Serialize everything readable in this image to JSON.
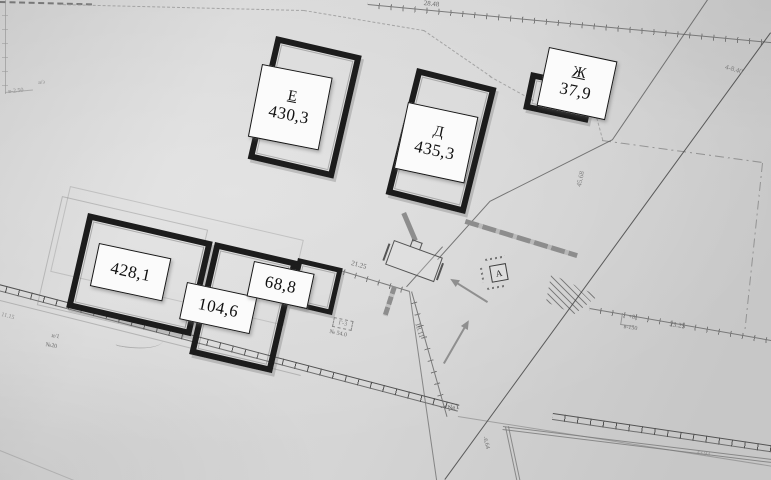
{
  "buildings": [
    {
      "letter": "Е",
      "area": "430,3"
    },
    {
      "letter": "Д",
      "area": "435,3"
    },
    {
      "letter": "Ж",
      "area": "37,9"
    },
    {
      "area": "428,1"
    },
    {
      "area": "104,6"
    },
    {
      "area": "68,8"
    }
  ],
  "ann": {
    "top_len": "28.48",
    "ne_len": "4-8.40",
    "east_len": "45.68",
    "s2125": "21.25",
    "s1811": "18.11",
    "no1": "№1",
    "g3": "Г-3",
    "g3no": "№ 54.0",
    "i1": "и/1",
    "no20": "№20",
    "az": "а/з",
    "v250": "в-2.50",
    "plus8": "+8",
    "v150": "в-150",
    "s2325": "23.25",
    "s664": "-6.64",
    "s4393": "43.93",
    "s1115": "11.15",
    "marker": "А"
  },
  "colors": {
    "paper": "#d4d4d4",
    "ink": "#1c1c1c",
    "label_bg": "#fbfbfb",
    "gray_fence": "#8d8d8d"
  }
}
